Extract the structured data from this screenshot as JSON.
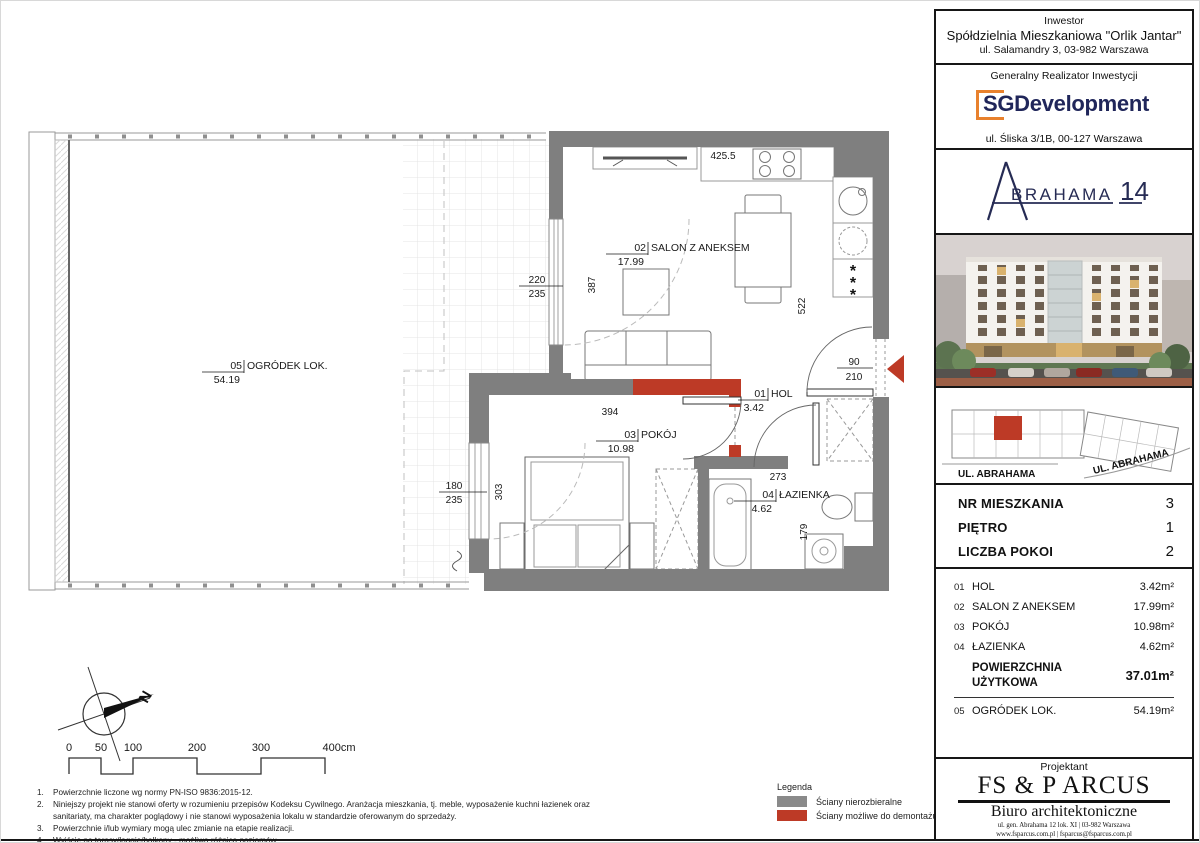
{
  "colors": {
    "wall_gray": "#7f7f7f",
    "wall_red": "#bd3a26",
    "navy": "#20265a",
    "orange": "#e8812d",
    "legend_gray": "#8a8a8a"
  },
  "sidebar": {
    "investor": {
      "label": "Inwestor",
      "name": "Spółdzielnia Mieszkaniowa \"Orlik Jantar\"",
      "address": "ul. Salamandry 3, 03-982 Warszawa"
    },
    "developer": {
      "label": "Generalny Realizator Inwestycji",
      "logo_text": "SGDevelopment",
      "address": "ul. Śliska 3/1B, 00-127 Warszawa"
    },
    "project": {
      "name": "BRAHAMA",
      "number": "14"
    },
    "siteplan": {
      "street_left": "UL. ABRAHAMA",
      "street_right": "UL. ABRAHAMA"
    },
    "unit_info": [
      {
        "label": "NR MIESZKANIA",
        "value": "3"
      },
      {
        "label": "PIĘTRO",
        "value": "1"
      },
      {
        "label": "LICZBA POKOI",
        "value": "2"
      }
    ],
    "rooms": [
      {
        "no": "01",
        "name": "HOL",
        "area": "3.42m²"
      },
      {
        "no": "02",
        "name": "SALON Z ANEKSEM",
        "area": "17.99m²"
      },
      {
        "no": "03",
        "name": "POKÓJ",
        "area": "10.98m²"
      },
      {
        "no": "04",
        "name": "ŁAZIENKA",
        "area": "4.62m²"
      }
    ],
    "total": {
      "label_line1": "POWIERZCHNIA",
      "label_line2": "UŻYTKOWA",
      "value": "37.01m²"
    },
    "garden_row": {
      "no": "05",
      "name": "OGRÓDEK LOK.",
      "area": "54.19m²"
    },
    "architect": {
      "label": "Projektant",
      "name": "FS & P ARCUS",
      "subtitle": "Biuro architektoniczne",
      "address_line1": "ul. gen. Abrahama 12 lok. XI | 03-982 Warszawa",
      "address_line2": "www.fsparcus.com.pl | fsparcus@fsparcus.com.pl"
    }
  },
  "plan": {
    "labels": {
      "garden": {
        "no": "05",
        "name": "OGRÓDEK LOK.",
        "area": "54.19"
      },
      "salon": {
        "no": "02",
        "name": "SALON Z ANEKSEM",
        "area": "17.99"
      },
      "hol": {
        "no": "01",
        "name": "HOL",
        "area": "3.42"
      },
      "pokoj": {
        "no": "03",
        "name": "POKÓJ",
        "area": "10.98"
      },
      "lazienka": {
        "no": "04",
        "name": "ŁAZIENKA",
        "area": "4.62"
      }
    },
    "dims": {
      "top_width": "425.5",
      "balcony_door": {
        "w": "220",
        "h": "235"
      },
      "salon_left": "387",
      "salon_right": "522",
      "entry_door": {
        "w": "90",
        "h": "210"
      },
      "pokoj_width": "394",
      "pokoj_window": {
        "w": "180",
        "h": "235"
      },
      "pokoj_height": "303",
      "lazienka_width": "273",
      "lazienka_height": "179"
    },
    "fridge_star": "*",
    "compass_letter": "N"
  },
  "scalebar": {
    "labels": [
      "0",
      "50",
      "100",
      "200",
      "300",
      "400cm"
    ]
  },
  "legend": {
    "title": "Legenda",
    "items": [
      {
        "label": "Ściany nierozbieralne",
        "color": "#8a8a8a"
      },
      {
        "label": "Ściany możliwe do demontażu",
        "color": "#bd3a26"
      }
    ]
  },
  "notes": [
    {
      "no": "1.",
      "text": "Powierzchnie liczone wg normy PN-ISO 9836:2015-12."
    },
    {
      "no": "2.",
      "text": "Niniejszy projekt nie stanowi oferty w rozumieniu przepisów Kodeksu Cywilnego. Aranżacja mieszkania, tj. meble, wyposażenie  kuchni łazienek oraz sanitariaty, ma charakter poglądowy i nie stanowi wyposażenia lokalu w standardzie oferowanym do sprzedaży."
    },
    {
      "no": "3.",
      "text": "Powierzchnie i/lub wymiary mogą ulec zmianie na etapie realizacji."
    },
    {
      "no": "4.",
      "text": "Wyjście na tarasy/loggie/balkony - możliwa różnica poziomów."
    }
  ]
}
